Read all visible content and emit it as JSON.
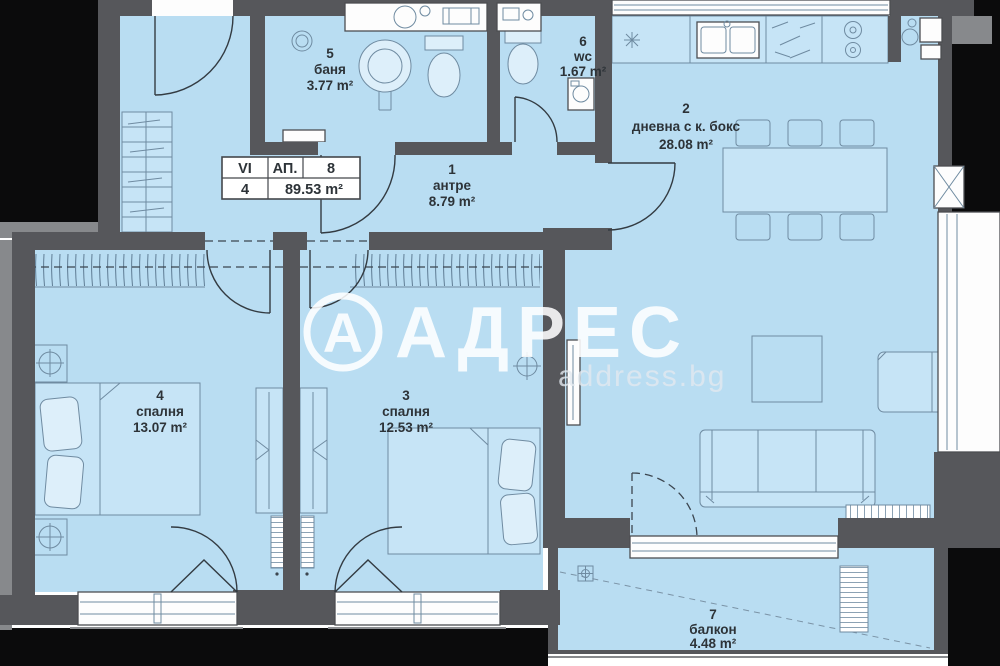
{
  "info_table": {
    "floor": "VI",
    "ap_label": "АП.",
    "ap_number": "8",
    "rooms_count": "4",
    "total_area": "89.53 m²"
  },
  "rooms": [
    {
      "number": "1",
      "name": "антре",
      "area": "8.79 m²"
    },
    {
      "number": "2",
      "name": "дневна с к. бокс",
      "area": "28.08 m²"
    },
    {
      "number": "3",
      "name": "спалня",
      "area": "12.53 m²"
    },
    {
      "number": "4",
      "name": "спалня",
      "area": "13.07 m²"
    },
    {
      "number": "5",
      "name": "баня",
      "area": "3.77 m²"
    },
    {
      "number": "6",
      "name": "wc",
      "area": "1.67 m²"
    },
    {
      "number": "7",
      "name": "балкон",
      "area": "4.48 m²"
    }
  ],
  "watermark": {
    "logo_letter": "А",
    "brand": "АДРЕС",
    "site": "address.bg"
  },
  "colors": {
    "floor": "#b9ddf2",
    "wall": "#56575b",
    "exterior": "#0b0b0c",
    "furniture_line": "#6f8ba1",
    "watermark": "#ffffff",
    "label_text": "#2d3338"
  }
}
